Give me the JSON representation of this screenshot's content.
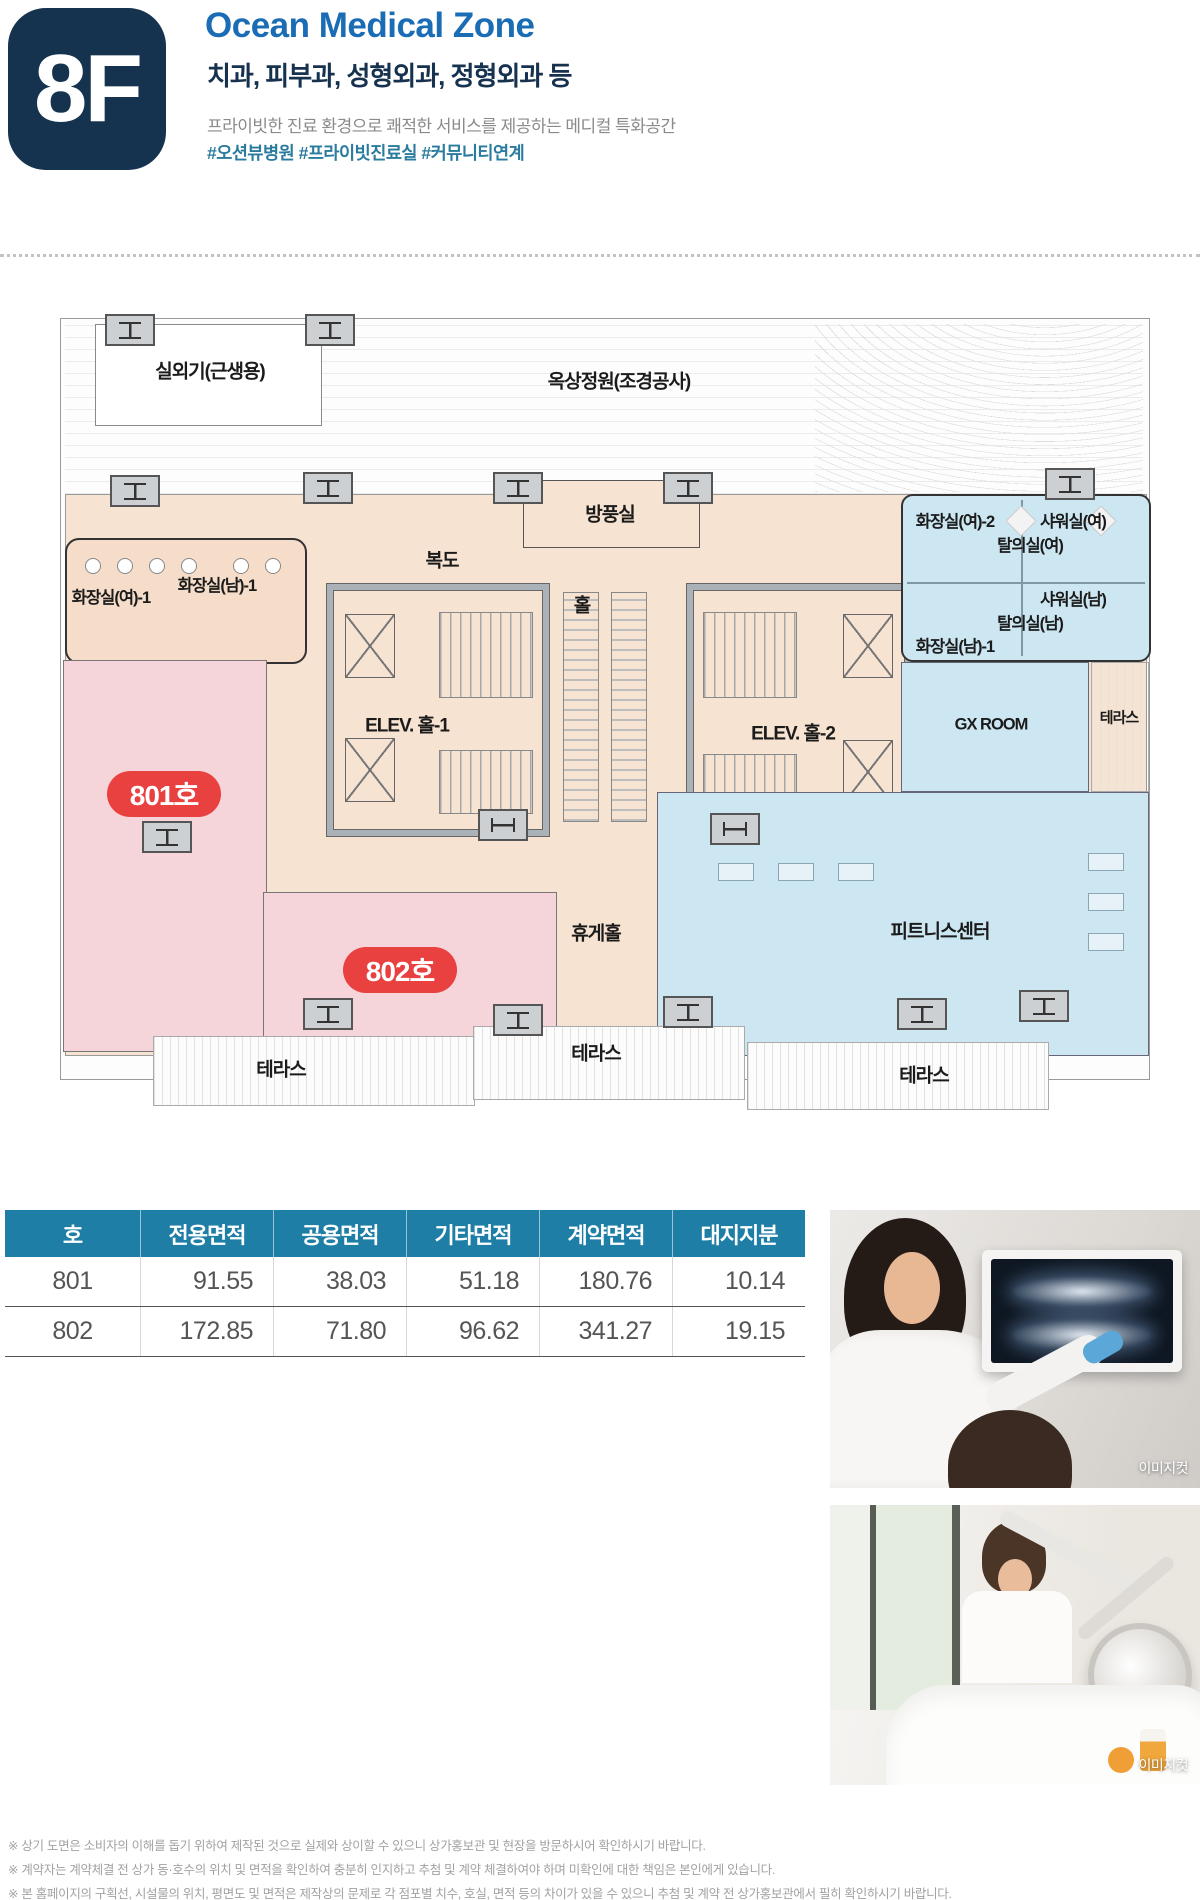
{
  "header": {
    "floor_label": "8F",
    "title": "Ocean Medical Zone",
    "subtitle": "치과, 피부과, 성형외과, 정형외과 등",
    "description": "프라이빗한 진료 환경으로 쾌적한 서비스를 제공하는 메디컬 특화공간",
    "hashtags": "#오션뷰병원 #프라이빗진료실 #커뮤니티연계"
  },
  "colors": {
    "badge_navy": "#15334e",
    "title_blue": "#1a6cb5",
    "hashtag_teal": "#2a7b9e",
    "interior_beige": "#f7e3d2",
    "unit_pink": "#f6d5da",
    "amenity_blue": "#cde7f2",
    "unit_badge_red": "#e94040",
    "table_header_teal": "#1e7ea6"
  },
  "floorplan": {
    "labels": {
      "outdoor_unit": "실외기(근생용)",
      "roof_garden": "옥상정원(조경공사)",
      "windbreak": "방풍실",
      "corridor": "복도",
      "hall": "홀",
      "toilet_w1": "화장실(여)-1",
      "toilet_m1": "화장실(남)-1",
      "toilet_w2": "화장실(여)-2",
      "shower_w": "샤워실(여)",
      "locker_w": "탈의실(여)",
      "shower_m": "샤워실(남)",
      "locker_m": "탈의실(남)",
      "elev_hall_1": "ELEV. 홀-1",
      "elev_hall_2": "ELEV. 홀-2",
      "gx_room": "GX ROOM",
      "terrace": "테라스",
      "unit_801": "801호",
      "unit_802": "802호",
      "lounge": "휴게홀",
      "fitness": "피트니스센터"
    }
  },
  "area_table": {
    "headers": [
      "호",
      "전용면적",
      "공용면적",
      "기타면적",
      "계약면적",
      "대지지분"
    ],
    "rows": [
      {
        "unit": "801",
        "exclusive": "91.55",
        "common": "38.03",
        "other": "51.18",
        "contract": "180.76",
        "land": "10.14"
      },
      {
        "unit": "802",
        "exclusive": "172.85",
        "common": "71.80",
        "other": "96.62",
        "contract": "341.27",
        "land": "19.15"
      }
    ]
  },
  "photos": {
    "caption": "이미지컷"
  },
  "footnotes": [
    "※ 상기 도면은 소비자의 이해를 돕기 위하여 제작된 것으로 실제와 상이할 수 있으니 상가홍보관 및 현장을 방문하시어 확인하시기 바랍니다.",
    "※ 계약자는 계약체결 전 상가 동·호수의 위치 및 면적을 확인하여 충분히 인지하고 추첨 및 계약 체결하여야 하며 미확인에 대한 책임은 본인에게 있습니다.",
    "※ 본 홈페이지의 구획선, 시설물의 위치, 평면도 및 면적은 제작상의 문제로 각 점포별 치수, 호실, 면적 등의 차이가 있을 수 있으니 추첨 및 계약 전 상가홍보관에서 필히 확인하시기 바랍니다."
  ]
}
